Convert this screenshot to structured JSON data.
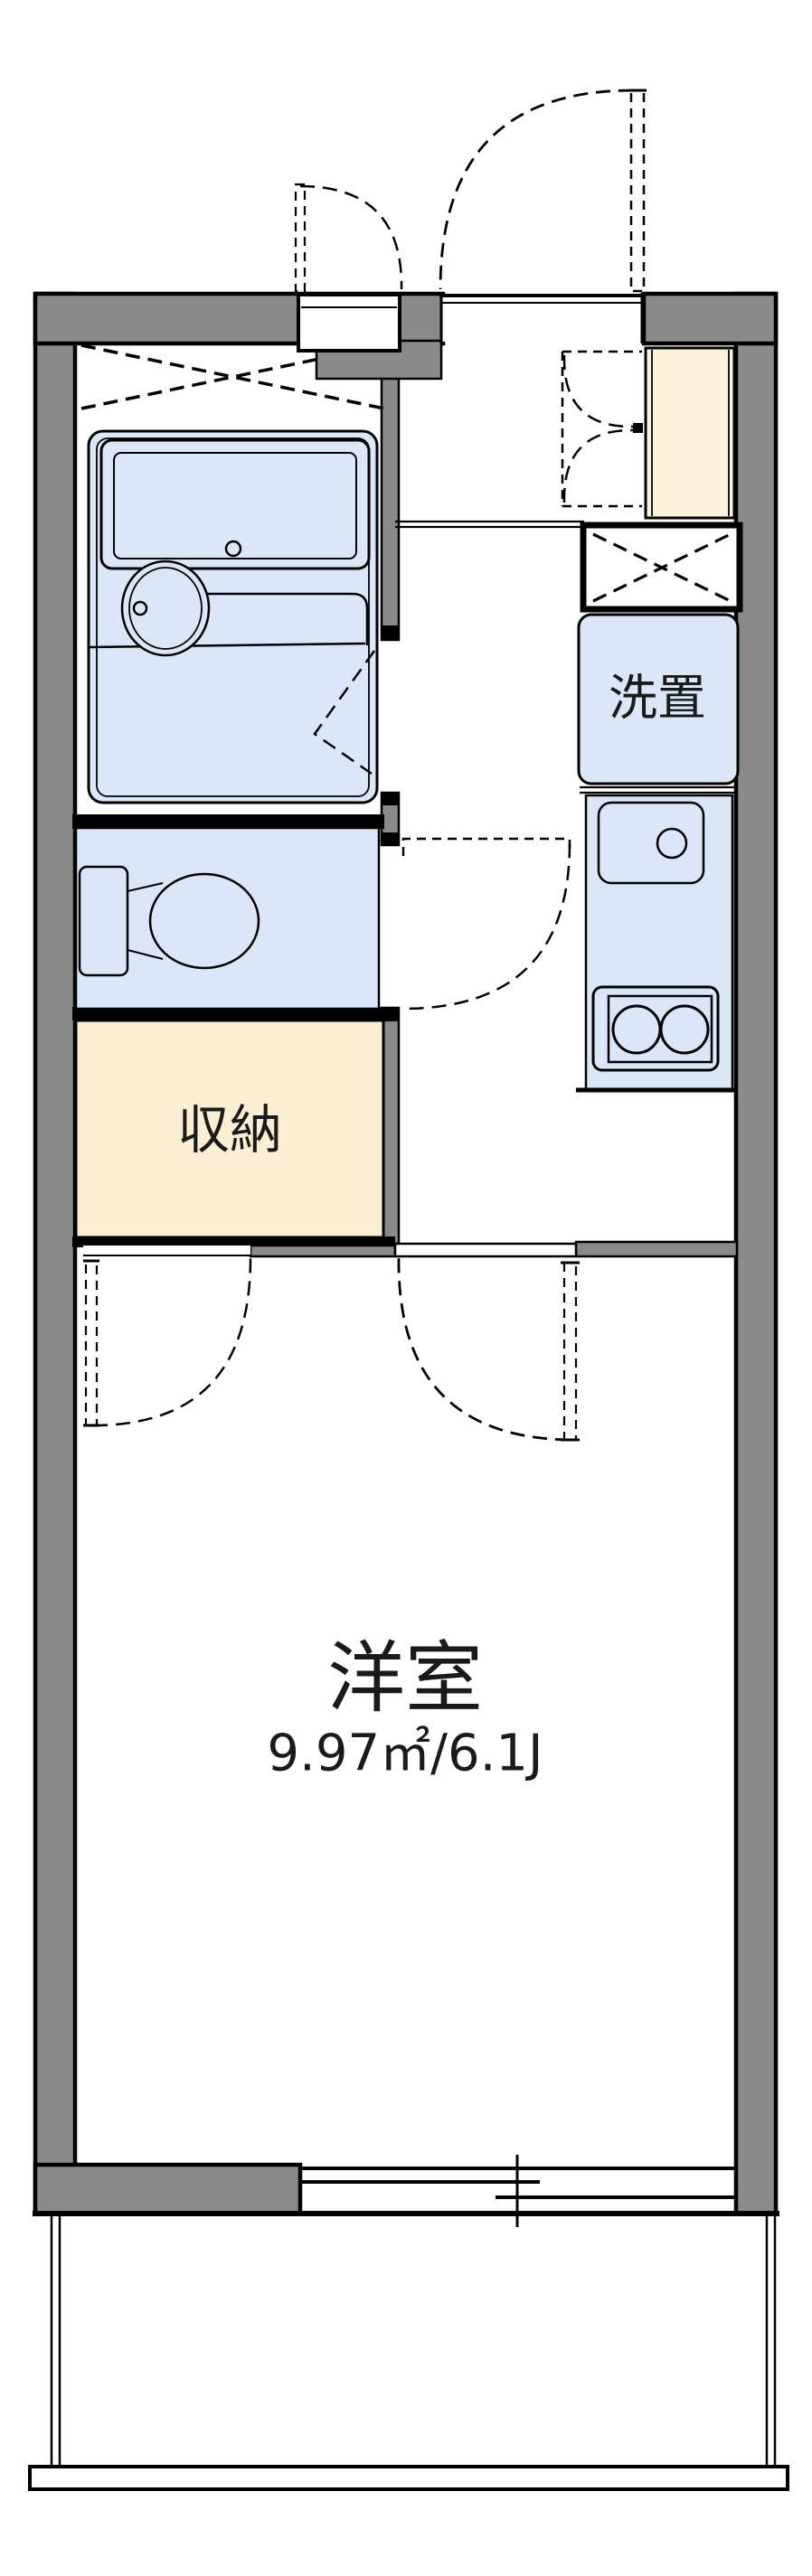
{
  "floorplan": {
    "labels": {
      "washer_space": "洗置",
      "storage": "収納",
      "main_room": "洋室",
      "main_room_area": "9.97㎡/6.1J"
    },
    "colors": {
      "wall_gray": "#8a8a8a",
      "fixture_blue": "#dbe7f6",
      "storage_beige": "#fbeed4",
      "cabinet_cream": "#fdf2dc",
      "line_black": "#000000",
      "background": "#ffffff"
    },
    "fixtures": [
      "entrance-door",
      "meter-box-door",
      "shoe-cabinet",
      "refrigerator-space",
      "washing-machine-space",
      "kitchen-sink",
      "gas-stove",
      "bathtub",
      "washbasin",
      "toilet",
      "storage-closet",
      "closet-door",
      "room-door",
      "sliding-window",
      "balcony-railing"
    ]
  }
}
